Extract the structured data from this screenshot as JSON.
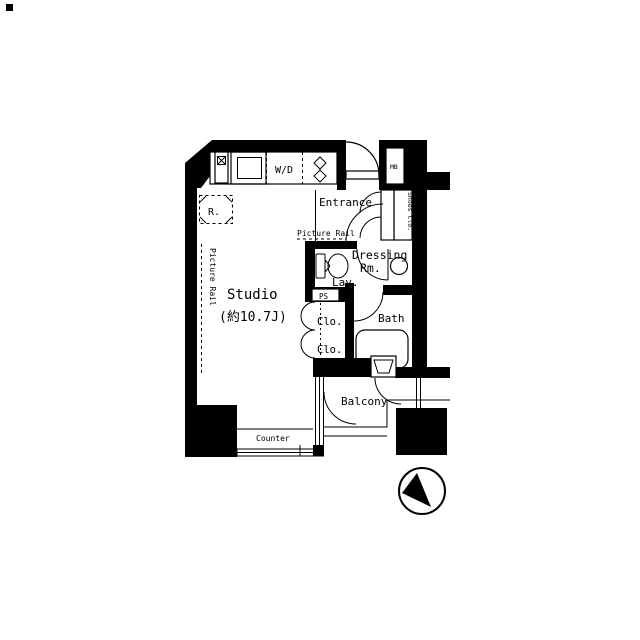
{
  "colors": {
    "ink": "#000000",
    "paper": "#ffffff"
  },
  "labels": {
    "entrance": "Entrance",
    "picture_rail_top": "Picture Rail",
    "picture_rail_left": "Picture Rail",
    "shoes_closet": "Shoes Clo.",
    "meter_box": "MB",
    "dressing_line1": "Dressing",
    "dressing_line2": "Rm.",
    "lavatory": "Lav.",
    "pipe_space": "PS",
    "studio_name": "Studio",
    "studio_size": "(約10.7J)",
    "closet_upper": "Clo.",
    "closet_lower": "Clo.",
    "bath": "Bath",
    "balcony": "Balcony",
    "counter": "Counter",
    "refrigerator": "R.",
    "washer_dryer": "W/D"
  },
  "icons": {
    "north-arrow-compass": "circle-with-black-wedge",
    "sink-icon": "inset-square",
    "stove-icon": "two-diamond-burners",
    "toilet-icon": "tank-and-bowl",
    "washer-icon": "circle",
    "bathtub-icon": "rounded-rectangle",
    "vent-icon": "crossed-box",
    "door-swing": "quarter-arc"
  }
}
